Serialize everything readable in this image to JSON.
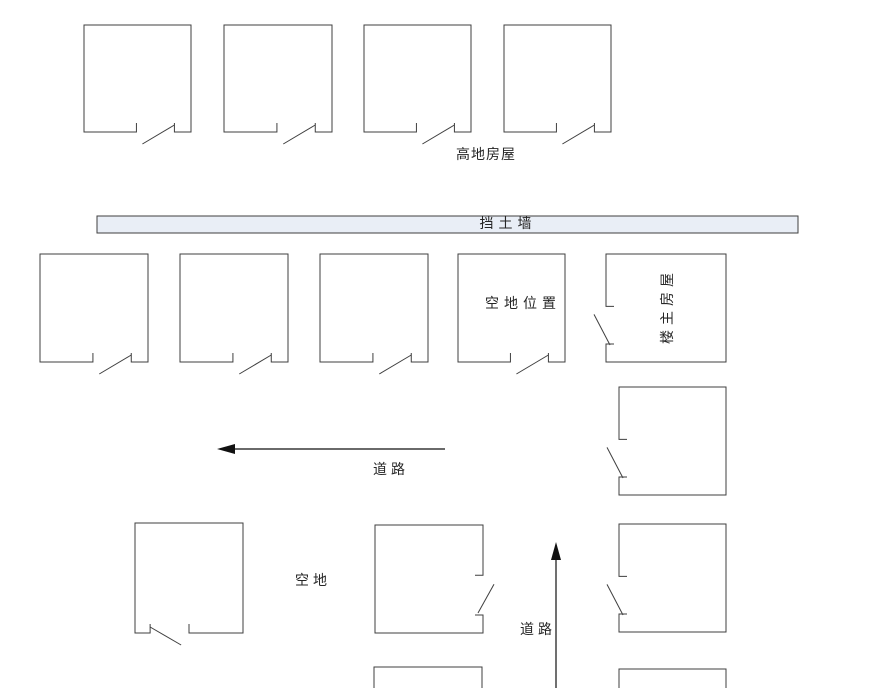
{
  "diagram": {
    "canvas": {
      "width": 886,
      "height": 688,
      "background": "#ffffff"
    },
    "style": {
      "line_color": "#3f3f3f",
      "arrow_color": "#111111",
      "text_color": "#262626",
      "wall_fill": "#e9eef6"
    },
    "labels": {
      "top_houses": {
        "text": "高地房屋",
        "x": 486,
        "y": 155,
        "spacing": 1
      },
      "retaining_wall": {
        "text": "挡土墙",
        "x": 508,
        "y": 224,
        "spacing": 5
      },
      "vacant_spot": {
        "text": "空地位置",
        "x": 523,
        "y": 304,
        "spacing": 5
      },
      "owner_house": {
        "text": "楼主房屋",
        "x": 668,
        "y": 306,
        "spacing": 5,
        "rotate": -90
      },
      "road_west": {
        "text": "道路",
        "x": 391,
        "y": 470,
        "spacing": 4
      },
      "vacant_area": {
        "text": "空地",
        "x": 313,
        "y": 581,
        "spacing": 4
      },
      "road_north": {
        "text": "道路",
        "x": 538,
        "y": 630,
        "spacing": 4
      }
    },
    "wall": {
      "x": 97,
      "y": 216,
      "w": 701,
      "h": 17
    },
    "houses": [
      {
        "id": "top-house-1",
        "x": 84,
        "y": 25,
        "w": 107,
        "h": 107,
        "door": "bottom"
      },
      {
        "id": "top-house-2",
        "x": 224,
        "y": 25,
        "w": 108,
        "h": 107,
        "door": "bottom"
      },
      {
        "id": "top-house-3",
        "x": 364,
        "y": 25,
        "w": 107,
        "h": 107,
        "door": "bottom"
      },
      {
        "id": "top-house-4",
        "x": 504,
        "y": 25,
        "w": 107,
        "h": 107,
        "door": "bottom"
      },
      {
        "id": "mid-house-1",
        "x": 40,
        "y": 254,
        "w": 108,
        "h": 108,
        "door": "bottom"
      },
      {
        "id": "mid-house-2",
        "x": 180,
        "y": 254,
        "w": 108,
        "h": 108,
        "door": "bottom"
      },
      {
        "id": "mid-house-3",
        "x": 320,
        "y": 254,
        "w": 108,
        "h": 108,
        "door": "bottom"
      },
      {
        "id": "vacant-spot-house",
        "x": 458,
        "y": 254,
        "w": 107,
        "h": 108,
        "door": "bottom"
      },
      {
        "id": "owner-house",
        "x": 606,
        "y": 254,
        "w": 120,
        "h": 108,
        "door": "left"
      },
      {
        "id": "right-house-1",
        "x": 619,
        "y": 387,
        "w": 107,
        "h": 108,
        "door": "left"
      },
      {
        "id": "right-house-2",
        "x": 619,
        "y": 524,
        "w": 107,
        "h": 108,
        "door": "left"
      },
      {
        "id": "right-house-3-partial",
        "x": 619,
        "y": 669,
        "w": 107,
        "h": 40,
        "door": "none"
      },
      {
        "id": "bottom-left-house",
        "x": 135,
        "y": 523,
        "w": 108,
        "h": 110,
        "door": "bottom-mirror"
      },
      {
        "id": "bottom-middle-house",
        "x": 375,
        "y": 525,
        "w": 108,
        "h": 108,
        "door": "right"
      },
      {
        "id": "bottom-middle-house-partial",
        "x": 374,
        "y": 667,
        "w": 108,
        "h": 40,
        "door": "none"
      }
    ],
    "arrows": [
      {
        "id": "road-arrow-west",
        "x1": 445,
        "y1": 449,
        "tipx": 217,
        "tipy": 449
      },
      {
        "id": "road-arrow-north",
        "x1": 556,
        "y1": 688,
        "tipx": 556,
        "tipy": 542
      }
    ]
  }
}
